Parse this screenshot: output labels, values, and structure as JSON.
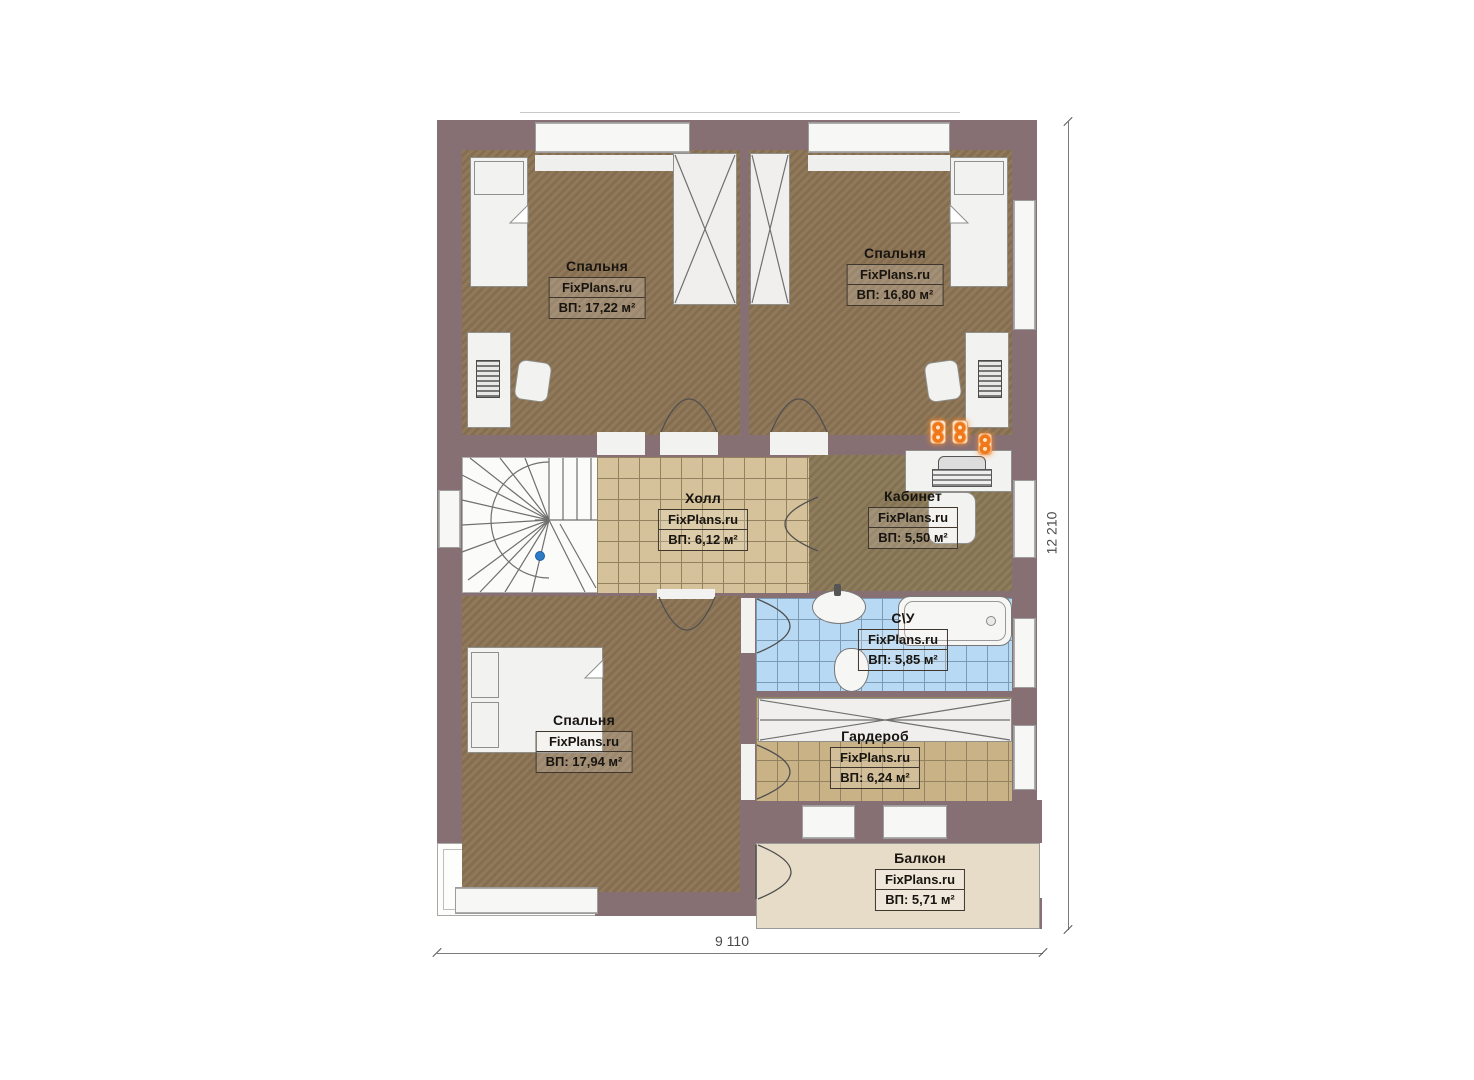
{
  "plan": {
    "watermark": "FixPlans.ru",
    "rooms": [
      {
        "name": "Спальня",
        "watermark": "FixPlans.ru",
        "area": "ВП: 17,22 м²"
      },
      {
        "name": "Спальня",
        "watermark": "FixPlans.ru",
        "area": "ВП: 16,80 м²"
      },
      {
        "name": "Холл",
        "watermark": "FixPlans.ru",
        "area": "ВП: 6,12 м²"
      },
      {
        "name": "Кабинет",
        "watermark": "FixPlans.ru",
        "area": "ВП: 5,50 м²"
      },
      {
        "name": "С\\У",
        "watermark": "FixPlans.ru",
        "area": "ВП: 5,85 м²"
      },
      {
        "name": "Спальня",
        "watermark": "FixPlans.ru",
        "area": "ВП: 17,94 м²"
      },
      {
        "name": "Гардероб",
        "watermark": "FixPlans.ru",
        "area": "ВП: 6,24 м²"
      },
      {
        "name": "Балкон",
        "watermark": "FixPlans.ru",
        "area": "ВП: 5,71 м²"
      }
    ],
    "dimensions": {
      "bottom": "9 110",
      "right": "12 210"
    },
    "colors": {
      "wall": "#877074",
      "floor_wood": "#8c7454",
      "tile_tan": "#d6c29a",
      "tile_blue": "#b7d9f4",
      "balcony_floor": "#e7dcc7",
      "accent_orange": "#f07818"
    }
  }
}
